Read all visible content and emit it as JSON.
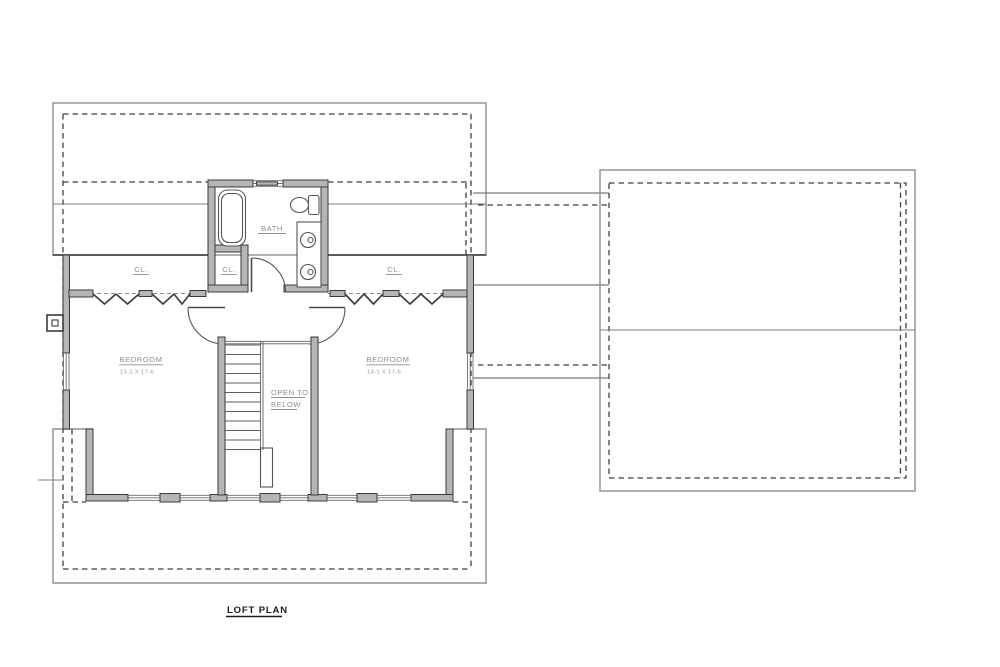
{
  "title_block": {
    "title": "LOFT PLAN"
  },
  "labels": {
    "bath": "BATH",
    "bath_closet": "CL.",
    "left_closet": "CL.",
    "right_closet": "CL.",
    "bedroom_left_name": "BEDROOM",
    "bedroom_left_dim": "13-1 X 17-6",
    "bedroom_right_name": "BEDROOM",
    "bedroom_right_dim": "13-1 X 17-6",
    "stair_open_line1": "OPEN TO",
    "stair_open_line2": "BELOW"
  },
  "colors": {
    "background": "#ffffff",
    "wall_fill": "#b5b5b5",
    "wall_edge": "#3a3a3a",
    "roof_outline": "#8f8f8f",
    "dashed_roof_line": "#3f3f3f",
    "label_text": "#8f8f8f",
    "title_text": "#1b1b1b"
  }
}
